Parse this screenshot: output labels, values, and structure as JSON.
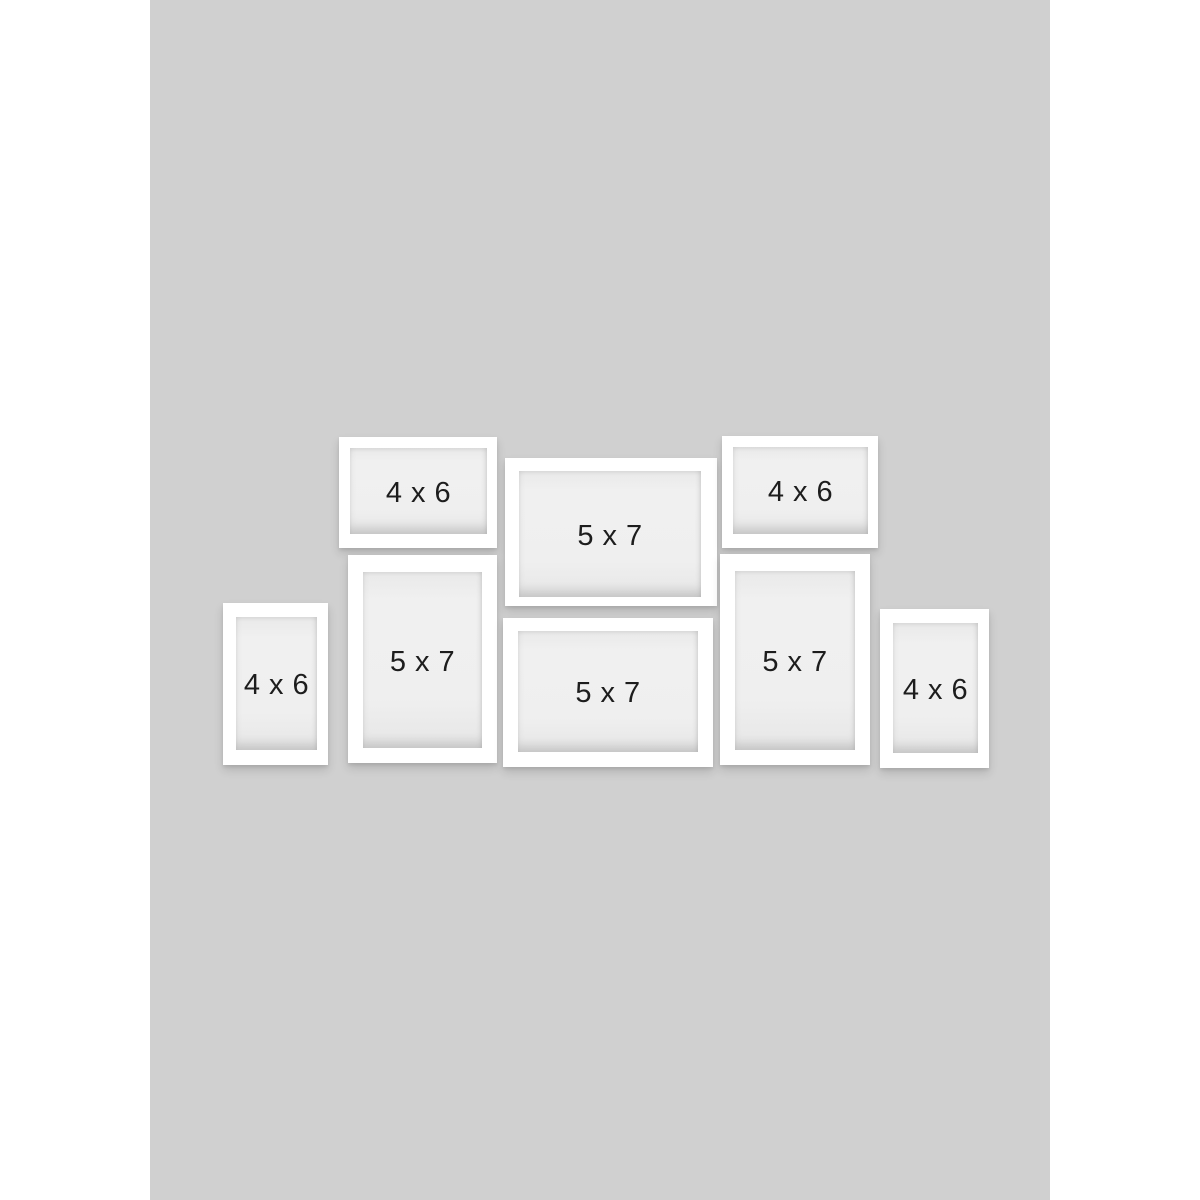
{
  "colors": {
    "page": "#ffffff",
    "backdrop": "#d0d0d0",
    "frame": "#ffffff",
    "mat": "#eeeeee",
    "text": "#1d1d1d"
  },
  "frames": [
    {
      "label": "4 x 6",
      "orientation": "landscape",
      "position": "top-left"
    },
    {
      "label": "5 x 7",
      "orientation": "landscape",
      "position": "top-center"
    },
    {
      "label": "4 x 6",
      "orientation": "landscape",
      "position": "top-right"
    },
    {
      "label": "4 x 6",
      "orientation": "portrait",
      "position": "bottom-far-left"
    },
    {
      "label": "5 x 7",
      "orientation": "portrait",
      "position": "bottom-left"
    },
    {
      "label": "5 x 7",
      "orientation": "landscape",
      "position": "bottom-center"
    },
    {
      "label": "5 x 7",
      "orientation": "portrait",
      "position": "bottom-right"
    },
    {
      "label": "4 x 6",
      "orientation": "portrait",
      "position": "bottom-far-right"
    }
  ]
}
